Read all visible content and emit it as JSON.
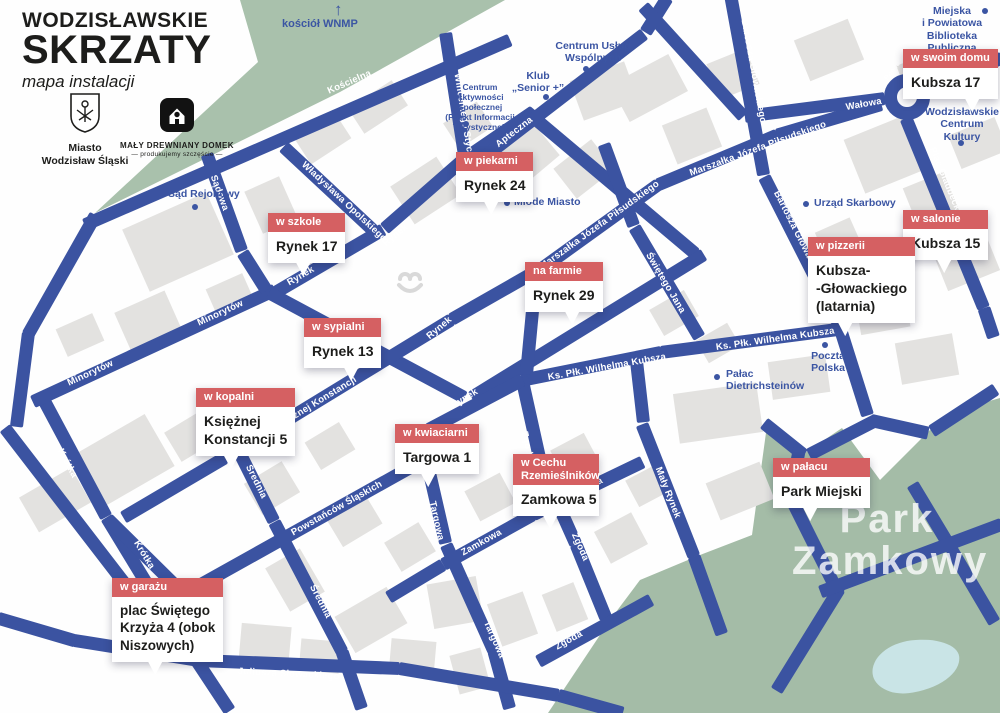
{
  "title": {
    "line1": "WODZISŁAWSKIE",
    "line2": "SKRZATY",
    "subtitle": "mapa instalacji"
  },
  "logos": {
    "city": {
      "line1": "Miasto",
      "line2": "Wodzisław Śląski"
    },
    "mdd": {
      "name": "MAŁY DREWNIANY DOMEK",
      "tagline": "— produkujemy szczęście —"
    }
  },
  "colors": {
    "road": "#3b53a1",
    "green": "#a9c1ac",
    "park": "#a4bca7",
    "pond": "#c9e4e6",
    "marker": "#d56062",
    "poi": "#3b55a3",
    "building": "#e3e2e0"
  },
  "streets": {
    "koscielna": {
      "name": "Kościelna"
    },
    "wincentego": {
      "name": "Wincentego Styczyńskiego"
    },
    "apteczna": {
      "name": "Apteczna"
    },
    "sadowa": {
      "name": "Sądowa"
    },
    "wladyslawa": {
      "name": "Władysława Opolskiego"
    },
    "bartosza": {
      "name": "Bartosza Głowackiego"
    },
    "marszalka": {
      "name": "Marszałka Józefa Piłsudskiego"
    },
    "walowa": {
      "name": "Wałowa"
    },
    "marca26": {
      "name": "26 Marca"
    },
    "rondo": {
      "name": "Rondo"
    },
    "gladbeck": {
      "name": "Plac Gladbeck"
    },
    "minorytow": {
      "name": "Minorytów"
    },
    "rynek": {
      "name": "Rynek"
    },
    "krotka": {
      "name": "Krótka"
    },
    "ksieznej": {
      "name": "Księżnej Konstancji"
    },
    "srednia": {
      "name": "Średnia"
    },
    "powstancow": {
      "name": "Powstańców Śląskich"
    },
    "targowa": {
      "name": "Targowa"
    },
    "zamkowa": {
      "name": "Zamkowa"
    },
    "zgoda": {
      "name": "Zgoda"
    },
    "maly_rynek": {
      "name": "Mały Rynek"
    },
    "swietego_jana": {
      "name": "Świętego Jana"
    },
    "wilhelma": {
      "name": "Ks. Płk. Wilhelma Kubsza"
    },
    "juliusza": {
      "name": "Juliusza Słowackiego"
    }
  },
  "pois": {
    "kosciol": {
      "label": "kościół WNMP",
      "arrow": "↑"
    },
    "cuw": {
      "lines": [
        "Centrum Usług",
        "Wspólnych"
      ]
    },
    "klub": {
      "lines": [
        "Klub",
        "„Senior +”"
      ]
    },
    "cas": {
      "lines": [
        "Centrum",
        "Aktywności",
        "Społecznej",
        "(Punkt Informacji",
        "Turystycznej)"
      ]
    },
    "mlode": {
      "label": "Młode Miasto"
    },
    "sad": {
      "label": "Sąd Rejonowy"
    },
    "urzad": {
      "label": "Urząd Skarbowy"
    },
    "biblioteka": {
      "lines": [
        "Miejska",
        "i Powiatowa",
        "Biblioteka",
        "Publiczna"
      ]
    },
    "wck": {
      "lines": [
        "Wodzisławskie",
        "Centrum",
        "Kultury"
      ]
    },
    "poczta": {
      "lines": [
        "Poczta",
        "Polska"
      ]
    },
    "palac": {
      "lines": [
        "Pałac",
        "Dietrichsteinów"
      ]
    }
  },
  "park_label": {
    "line1": "Park",
    "line2": "Zamkowy"
  },
  "callouts": {
    "swoim_domu": {
      "tag": "w swoim domu",
      "lines": [
        "Kubsza 17"
      ]
    },
    "salonie": {
      "tag": "w salonie",
      "lines": [
        "Kubsza 15"
      ]
    },
    "pizzerii": {
      "tag": "w pizzerii",
      "lines": [
        "Kubsza-",
        "-Głowackiego",
        "(latarnia)"
      ]
    },
    "piekarni": {
      "tag": "w piekarni",
      "lines": [
        "Rynek 24"
      ]
    },
    "szkole": {
      "tag": "w szkole",
      "lines": [
        "Rynek 17"
      ]
    },
    "farmie": {
      "tag": "na farmie",
      "lines": [
        "Rynek 29"
      ]
    },
    "sypialni": {
      "tag": "w sypialni",
      "lines": [
        "Rynek 13"
      ]
    },
    "kopalni": {
      "tag": "w kopalni",
      "lines": [
        "Księżnej",
        "Konstancji 5"
      ]
    },
    "kwiaciarni": {
      "tag": "w kwiaciarni",
      "lines": [
        "Targowa 1"
      ]
    },
    "cechu": {
      "tag": "w Cechu Rzemieślników",
      "lines": [
        "Zamkowa 5"
      ]
    },
    "palacu": {
      "tag": "w pałacu",
      "lines": [
        "Park Miejski"
      ]
    },
    "garazu": {
      "tag": "w garażu",
      "lines": [
        "plac Świętego",
        "Krzyża 4 (obok",
        "Niszowych)"
      ]
    }
  }
}
